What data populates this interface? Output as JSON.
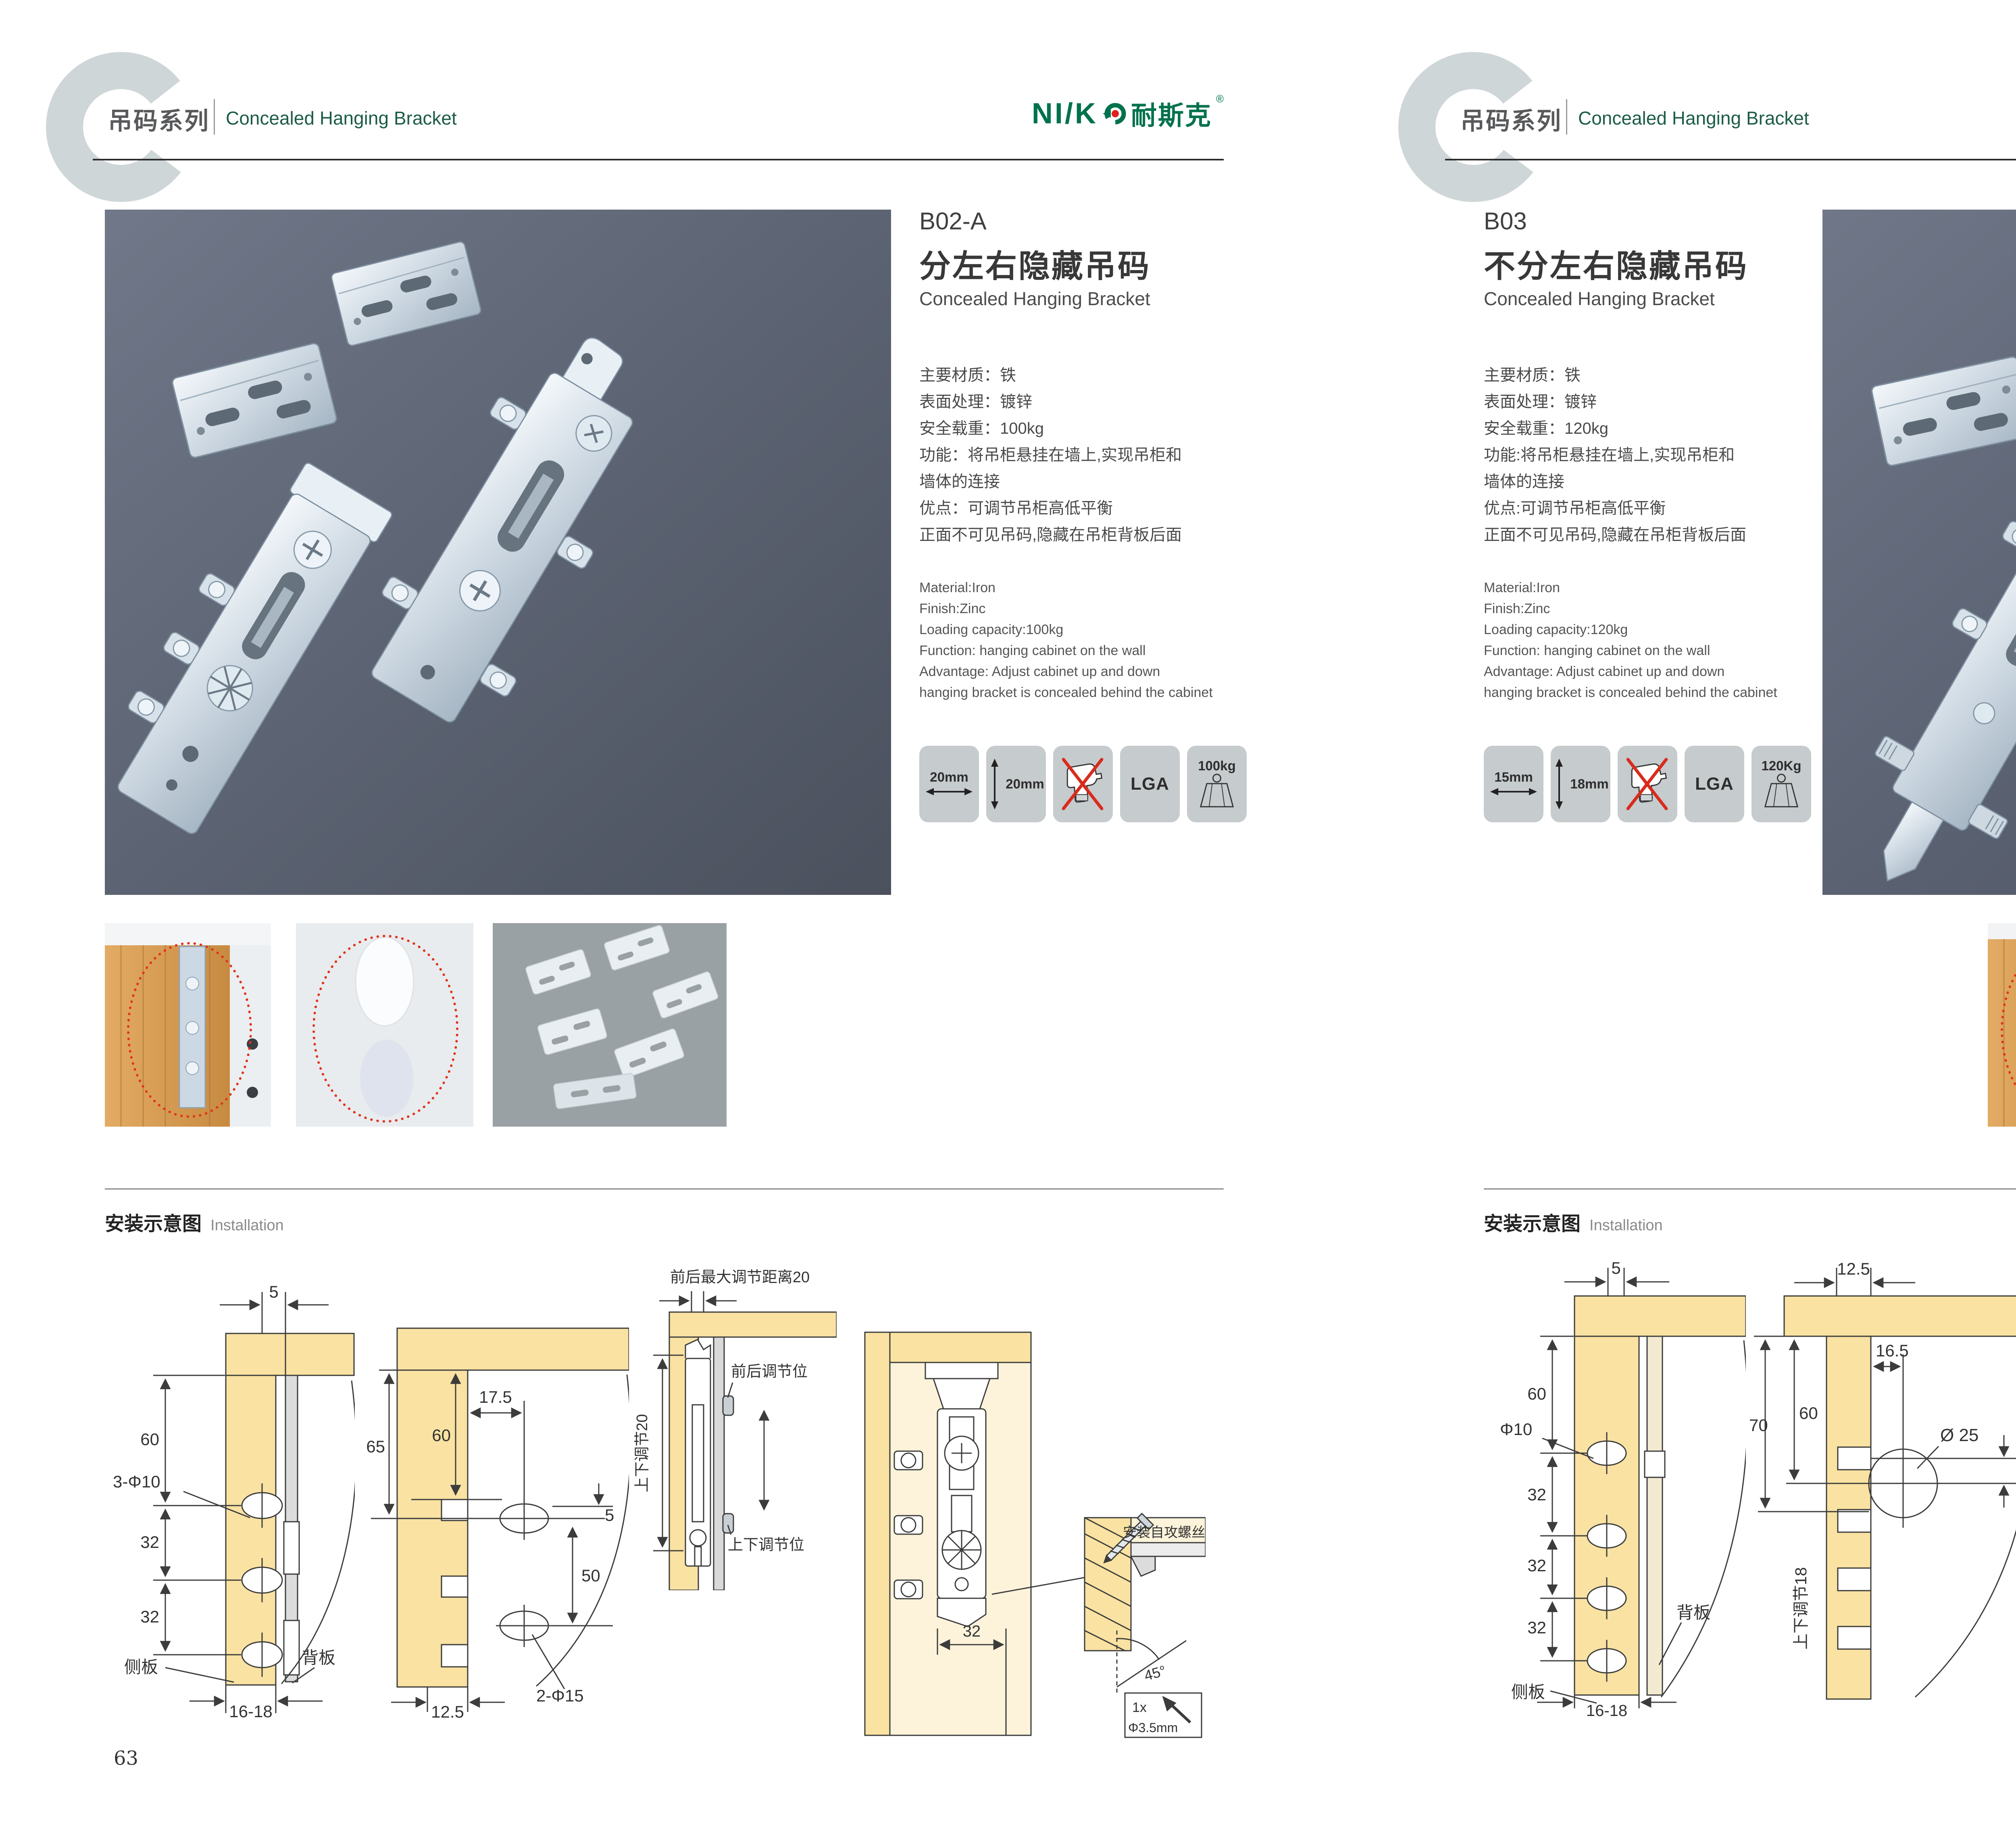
{
  "brand": {
    "latin": "NI/K",
    "cjk": "耐斯克",
    "reg": "®"
  },
  "pages": [
    {
      "page_no": "63",
      "series_cn": "吊码系列",
      "series_en": "Concealed Hanging Bracket",
      "product": {
        "code": "B02-A",
        "name_cn": "分左右隐藏吊码",
        "name_en": "Concealed Hanging Bracket",
        "specs_cn": [
          "主要材质：铁",
          "表面处理：镀锌",
          "安全载重：100kg",
          "功能：将吊柜悬挂在墙上,实现吊柜和",
          "墙体的连接",
          "优点：可调节吊柜高低平衡",
          "正面不可见吊码,隐藏在吊柜背板后面"
        ],
        "specs_en": [
          "Material:Iron",
          "Finish:Zinc",
          "Loading capacity:100kg",
          "Function: hanging cabinet on the wall",
          "Advantage: Adjust cabinet up and down",
          "hanging bracket is concealed behind the cabinet"
        ],
        "badge_width": "20mm",
        "badge_height": "20mm",
        "badge_lga": "LGA",
        "badge_load": "100kg"
      },
      "install": {
        "title_cn": "安装示意图",
        "title_en": "Installation",
        "d1": {
          "top": "5",
          "a": "60",
          "hole": "3-Φ10",
          "b": "32",
          "c": "32",
          "side": "侧板",
          "back": "背板",
          "bottom": "16-18"
        },
        "d2": {
          "a": "65",
          "b": "60",
          "c": "17.5",
          "d": "5",
          "e": "50",
          "hole": "2-Φ15",
          "bottom": "12.5"
        },
        "d3": {
          "top": "前后最大调节距离20",
          "left": "上下调节20",
          "mid": "前后调节位",
          "bottom": "上下调节位"
        },
        "d4": {
          "w": "32",
          "screw": "安装自攻螺丝",
          "angle": "45°",
          "qty": "1x",
          "dia": "Φ3.5mm"
        }
      }
    },
    {
      "page_no": "64",
      "series_cn": "吊码系列",
      "series_en": "Concealed Hanging Bracket",
      "product": {
        "code": "B03",
        "name_cn": "不分左右隐藏吊码",
        "name_en": "Concealed Hanging Bracket",
        "specs_cn": [
          "主要材质：铁",
          "表面处理：镀锌",
          "安全载重：120kg",
          "功能:将吊柜悬挂在墙上,实现吊柜和",
          "墙体的连接",
          "优点:可调节吊柜高低平衡",
          "正面不可见吊码,隐藏在吊柜背板后面"
        ],
        "specs_en": [
          "Material:Iron",
          "Finish:Zinc",
          "Loading capacity:120kg",
          "Function: hanging cabinet on the wall",
          "Advantage: Adjust cabinet up and down",
          "hanging bracket is concealed behind the cabinet"
        ],
        "badge_width": "15mm",
        "badge_height": "18mm",
        "badge_lga": "LGA",
        "badge_load": "120Kg"
      },
      "install": {
        "title_cn": "安装示意图",
        "title_en": "Installation",
        "d1": {
          "top": "5",
          "a": "60",
          "hole": "Φ10",
          "b": "32",
          "c": "32",
          "d": "32",
          "back": "背板",
          "side": "侧板",
          "bottom": "16-18"
        },
        "d2": {
          "top": "12.5",
          "a": "70",
          "b": "60",
          "c": "16.5",
          "dia": "Ø 25",
          "gap": "10",
          "left": "上下调节18"
        },
        "d3": {
          "top": "16.5",
          "a": "12.5",
          "b": "10",
          "dia": "ø25",
          "lock": "锁紧状态",
          "screw": "安装自攻螺丝",
          "angle": "45°",
          "qty": "1x",
          "dia2": "Φ3.5mm"
        }
      }
    }
  ]
}
